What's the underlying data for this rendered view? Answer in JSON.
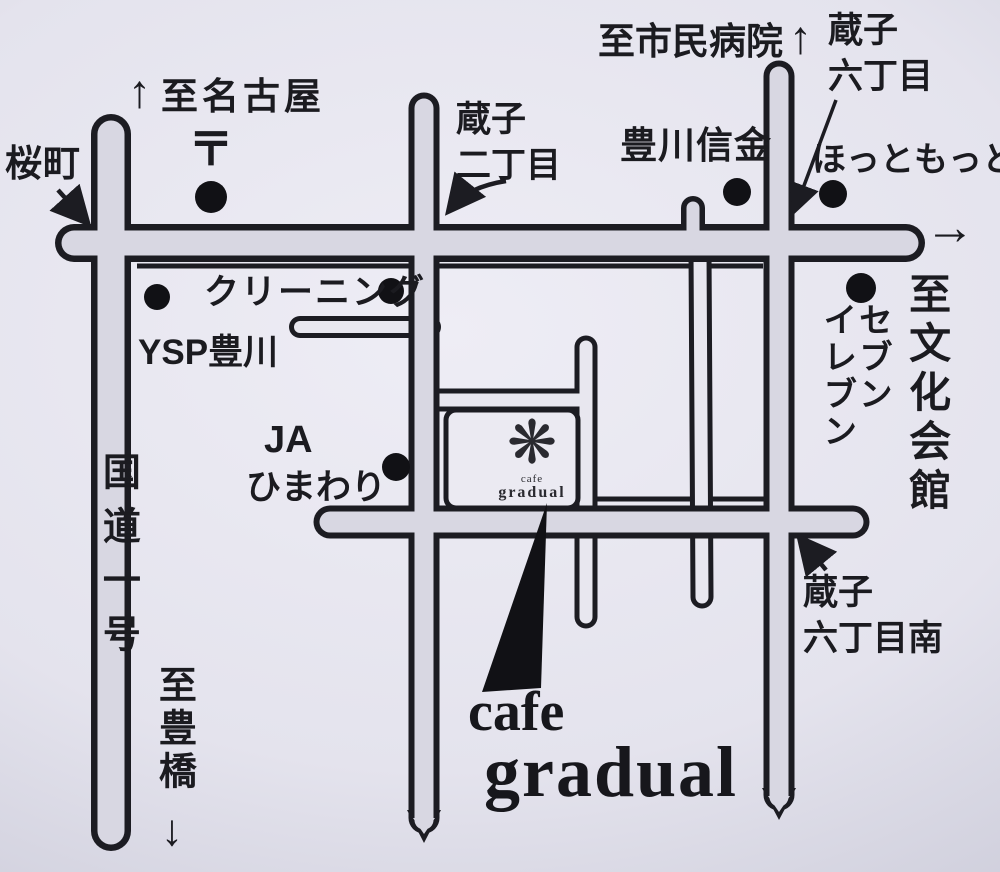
{
  "colors": {
    "paper_center": "#eeedf5",
    "paper_edge": "#acacc0",
    "road_fill": "#d8d7e2",
    "minor_fill": "#e8e7ef",
    "ink": "#1c1c22"
  },
  "labels": {
    "to_nagoya": {
      "arrow": "↑",
      "text": "至名古屋"
    },
    "post_office_mark": "〒",
    "sakuramachi": "桜町",
    "kurako2": {
      "line1": "蔵子",
      "line2": "二丁目"
    },
    "to_hospital": {
      "text": "至市民病院",
      "arrow": "↑"
    },
    "kurako6": {
      "line1": "蔵子",
      "line2": "六丁目"
    },
    "hottomotto": "ほっともっと",
    "shinkin": "豊川信金",
    "main_road_arrow": "→",
    "to_bunka_kaikan": "至文化会館",
    "seven_eleven": {
      "col_right": "セブン",
      "col_left": "イレブン"
    },
    "cleaning": "クリーニング",
    "ysp": "YSP豊川",
    "ja": {
      "line1": "JA",
      "line2": "ひまわり"
    },
    "route1": "国道一号",
    "to_toyohashi": {
      "text": "至豊橋",
      "arrow": "↓"
    },
    "kurako6_minami": {
      "line1": "蔵子",
      "line2": "六丁目南"
    },
    "cafe_logo": {
      "icon": "❋",
      "tiny1": "cafe",
      "tiny2": "gradual"
    },
    "cafe_title": {
      "line1": "cafe",
      "line2": "gradual"
    }
  }
}
